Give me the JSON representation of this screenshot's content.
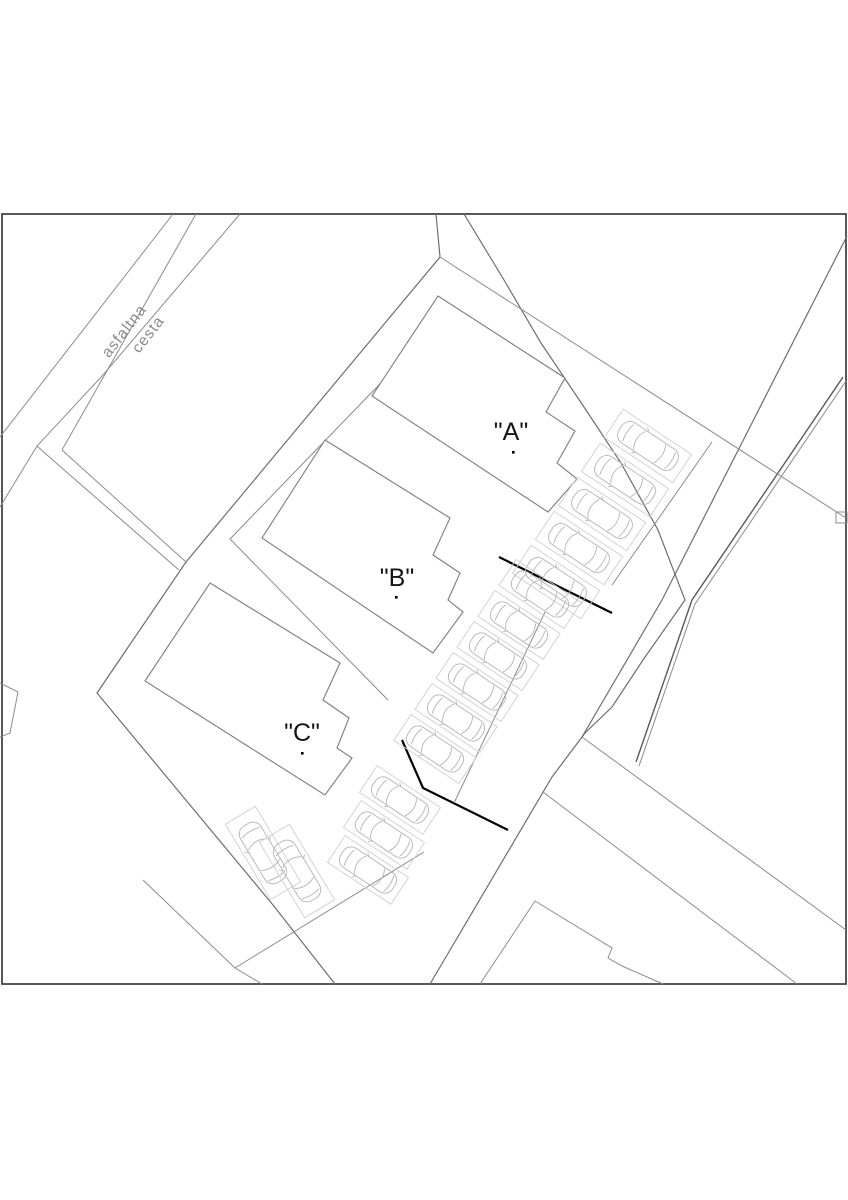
{
  "drawing": {
    "type": "site-plan",
    "road": {
      "name_line1": "asfaltna",
      "name_line2": "cesta"
    },
    "buildings": [
      {
        "id": "building-a",
        "label": "\"A\""
      },
      {
        "id": "building-b",
        "label": "\"B\""
      },
      {
        "id": "building-c",
        "label": "\"C\""
      }
    ],
    "parking": {
      "total_stalls": 16,
      "rows": [
        {
          "id": "row-a",
          "stalls": 5
        },
        {
          "id": "row-b",
          "stalls": 6
        },
        {
          "id": "row-c",
          "stalls": 3
        },
        {
          "id": "row-d",
          "stalls": 2
        }
      ]
    },
    "colors": {
      "paper": "#ffffff",
      "frame": "#3c3c3c",
      "parcel_line": "#8c8c8c",
      "boundary_black": "#000000",
      "car_outline": "#b4b4b4"
    }
  }
}
